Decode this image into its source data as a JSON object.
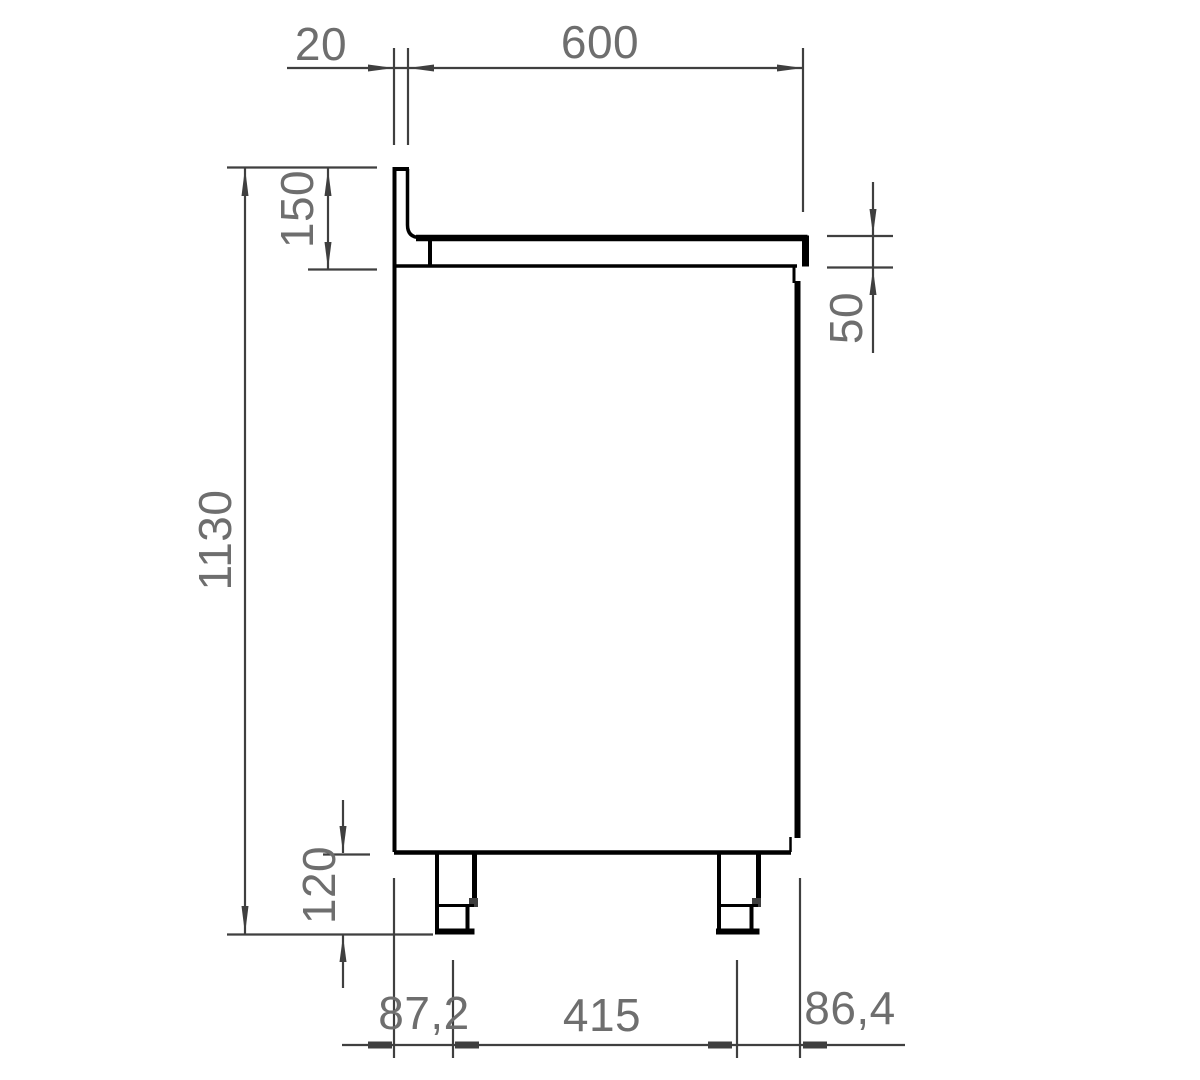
{
  "drawing": {
    "view": "side-view-technical-drawing",
    "labels": {
      "backsplash_thickness": "20",
      "depth": "600",
      "backsplash_height": "150",
      "total_height": "1130",
      "worktop_edge_thickness": "50",
      "leg_height": "120",
      "rear_leg_offset": "87,2",
      "leg_spacing": "415",
      "front_leg_offset": "86,4"
    },
    "colors": {
      "object_line": "#000000",
      "dimension_line": "#3f3f3f",
      "label_text": "#6e6e6e",
      "background": "#ffffff"
    }
  }
}
